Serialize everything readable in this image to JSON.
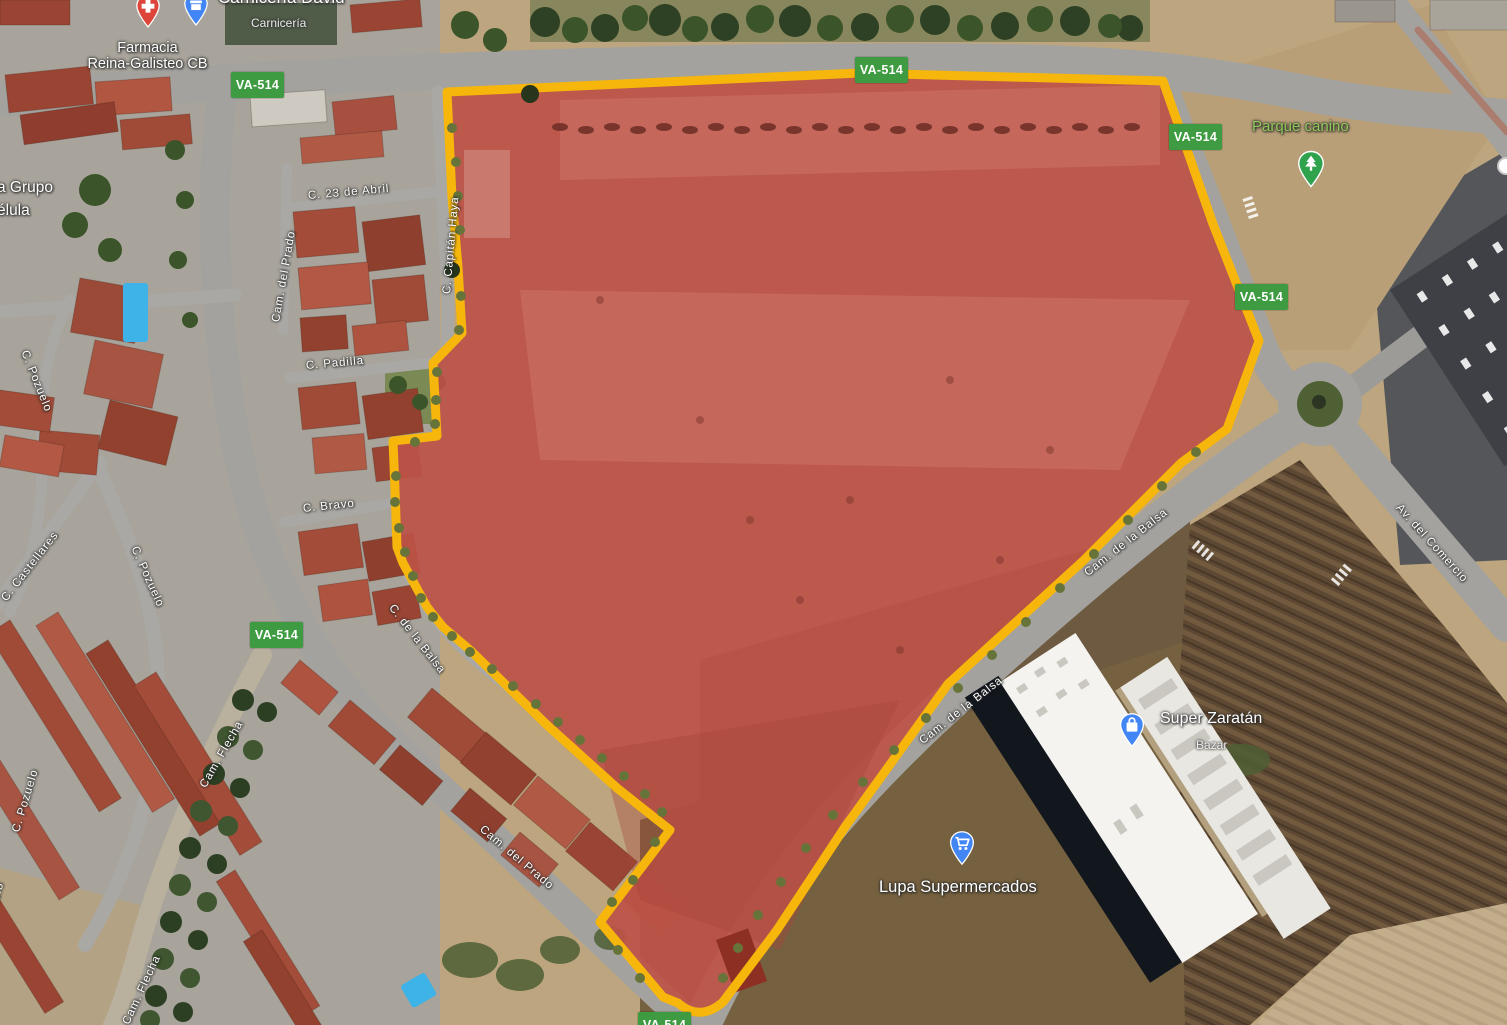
{
  "map": {
    "route_shield": "VA-514",
    "streets": {
      "abril": "C. 23 de Abril",
      "prado": "Cam. del Prado",
      "haya": "C. Capitán Haya",
      "padilla": "C. Padilla",
      "bravo": "C. Bravo",
      "balsa_st": "C. de la Balsa",
      "cam_balsa": "Cam. de la Balsa",
      "comercio": "Av. del Comercio",
      "castellares": "C. Castellares",
      "pozuelo": "C. Pozuelo",
      "pozuelo_partial": "uelo",
      "flecha": "Cam. Flecha"
    },
    "pois": {
      "farmacia_line1": "Farmacia",
      "farmacia_line2": "Reina-Galisteo CB",
      "carniceria_name": "Carnicería David",
      "carniceria_type": "Carnicería",
      "grupo_line1": "a Grupo",
      "grupo_line2": "élula",
      "parque": "Parque canino",
      "zaratan_name": "Super Zaratán",
      "zaratan_type": "Bazar",
      "lupa": "Lupa Supermercados"
    },
    "colors": {
      "parcel_fill": "#BD5348",
      "parcel_border": "#F6B60B",
      "shield_bg": "#3E9B41",
      "park_text": "#8FCA5A",
      "pin_red": "#DD453A",
      "pin_blue": "#4285F4",
      "pin_green": "#2FA24E"
    }
  }
}
